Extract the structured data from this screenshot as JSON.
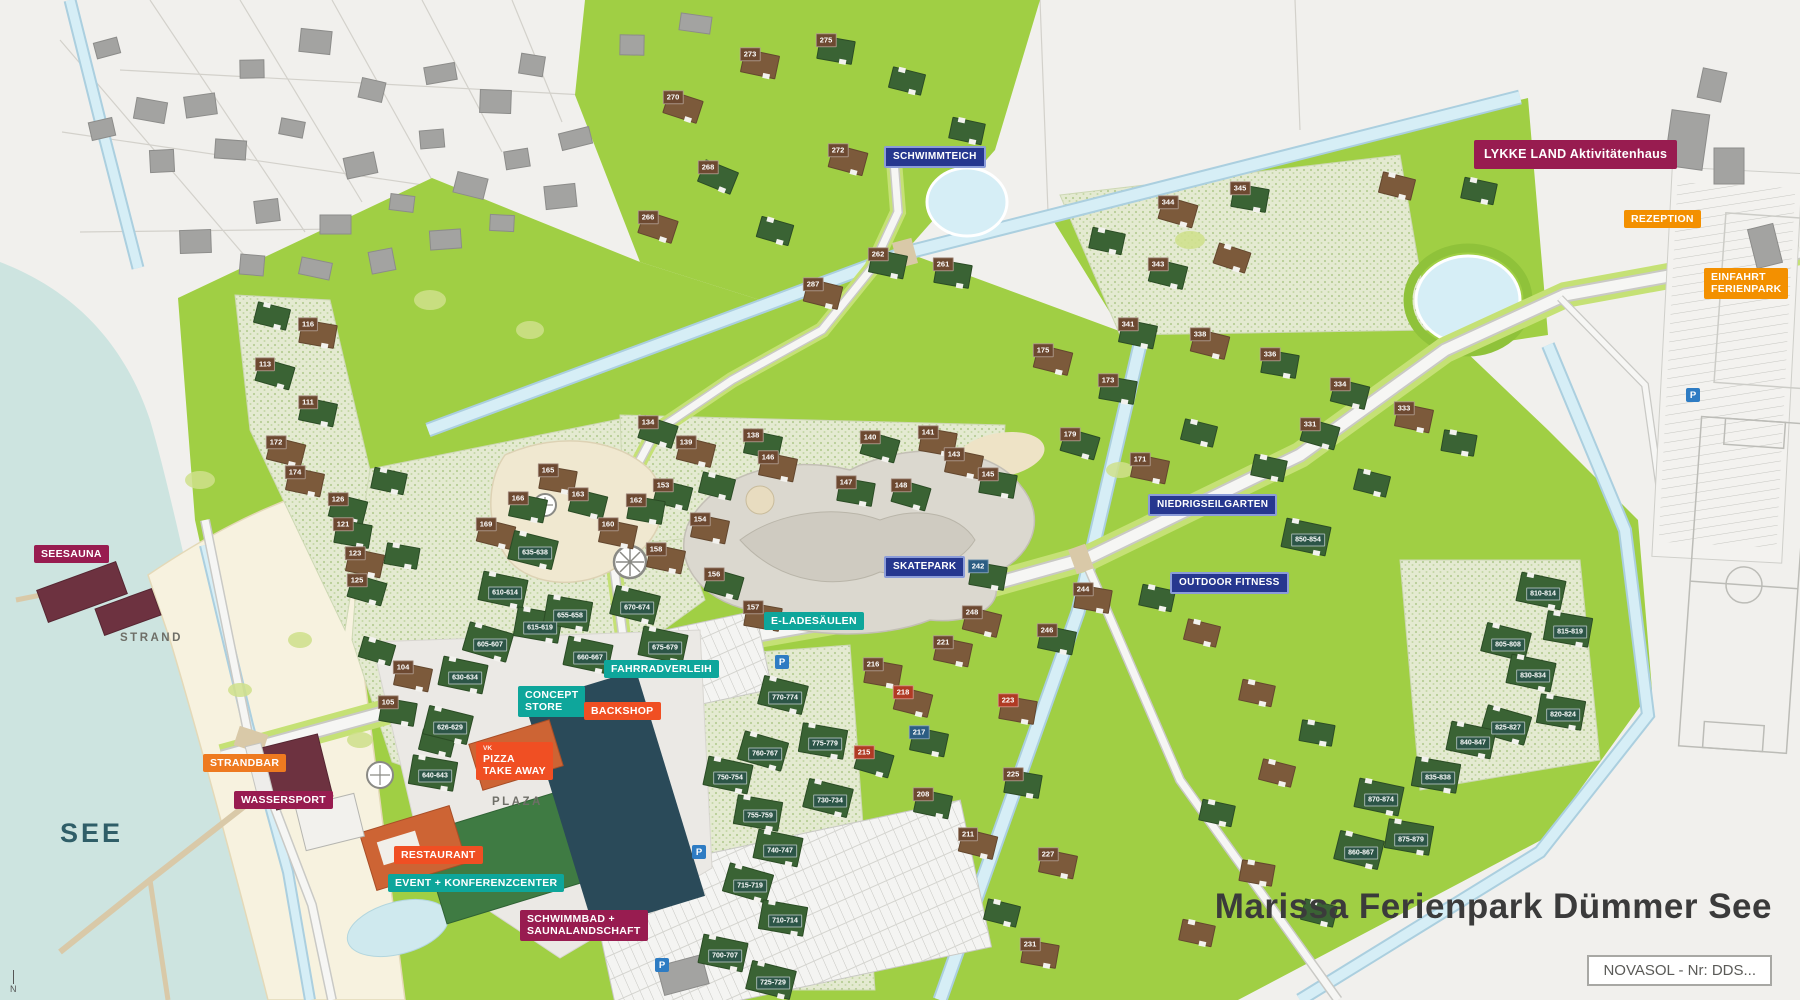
{
  "title": "Marissa Ferienpark Dümmer See",
  "info_box": "NOVASOL - Nr: DDS...",
  "north": "N",
  "areas": {
    "see": "SEE",
    "strand": "STRAND",
    "plaza": "PLAZA"
  },
  "colors": {
    "badge_berry": "#981c50",
    "badge_orange": "#f39000",
    "badge_orangered": "#f04f23",
    "badge_teal": "#0ea69b",
    "badge_blue": "#26378f",
    "badge_blue_border": "#8b9cd9",
    "house_range_badge": "#2c5547",
    "house_number_badge": "#6d4931",
    "park_green": "#a0cf44",
    "lake": "#cde4e0",
    "beach": "#f7f2df",
    "pool_building": "#2a4a59",
    "roof_green": "#3a6334",
    "roof_brown": "#7c5a3b",
    "parking_p": "#2e7cc3",
    "title_text": "#3b3b3b"
  },
  "poi_labels": [
    {
      "t": "SCHWIMMTEICH",
      "s": "blue",
      "x": 884,
      "y": 146
    },
    {
      "t": "LYKKE LAND Aktivitätenhaus",
      "s": "berry",
      "x": 1474,
      "y": 140,
      "big": 1
    },
    {
      "t": "REZEPTION",
      "s": "orange",
      "x": 1624,
      "y": 210
    },
    {
      "t": "EINFAHRT",
      "t2": "FERIENPARK",
      "s": "orange",
      "x": 1704,
      "y": 268
    },
    {
      "t": "NIEDRIGSEILGARTEN",
      "s": "blue",
      "x": 1148,
      "y": 494
    },
    {
      "t": "OUTDOOR FITNESS",
      "s": "blue",
      "x": 1170,
      "y": 572
    },
    {
      "t": "SKATEPARK",
      "s": "blue",
      "x": 884,
      "y": 556
    },
    {
      "t": "E-LADESÄULEN",
      "s": "teal",
      "x": 764,
      "y": 612
    },
    {
      "t": "FAHRRADVERLEIH",
      "s": "teal",
      "x": 604,
      "y": 660
    },
    {
      "t": "CONCEPT",
      "t2": "STORE",
      "s": "teal",
      "x": 518,
      "y": 686
    },
    {
      "t": "BACKSHOP",
      "s": "orangered",
      "x": 584,
      "y": 702
    },
    {
      "t": "PIZZA",
      "t2": "TAKE AWAY",
      "s": "orangered",
      "x": 476,
      "y": 742,
      "pre": "VK"
    },
    {
      "t": "RESTAURANT",
      "s": "orangered",
      "x": 394,
      "y": 846
    },
    {
      "t": "EVENT + KONFERENZCENTER",
      "s": "teal",
      "x": 388,
      "y": 874
    },
    {
      "t": "SCHWIMMBAD +",
      "t2": "SAUNALANDSCHAFT",
      "s": "berry",
      "x": 520,
      "y": 910
    },
    {
      "t": "SEESAUNA",
      "s": "berry",
      "x": 34,
      "y": 545
    },
    {
      "t": "STRANDBAR",
      "s": "orange2",
      "x": 203,
      "y": 754
    },
    {
      "t": "WASSERSPORT",
      "s": "berry",
      "x": 234,
      "y": 791
    }
  ],
  "parking_icons": [
    {
      "x": 775,
      "y": 655
    },
    {
      "x": 692,
      "y": 845
    },
    {
      "x": 655,
      "y": 958
    },
    {
      "x": 1686,
      "y": 388
    }
  ],
  "parking_icon_label": "P",
  "houses": [
    [
      665,
      95,
      18,
      "b",
      "270",
      "b"
    ],
    [
      742,
      52,
      12,
      "b",
      "273",
      "b"
    ],
    [
      818,
      38,
      10,
      "g",
      "275",
      "b"
    ],
    [
      890,
      70,
      14,
      "g",
      "",
      ""
    ],
    [
      830,
      148,
      15,
      "b",
      "272",
      "b"
    ],
    [
      700,
      165,
      22,
      "g",
      "268",
      "b"
    ],
    [
      640,
      215,
      18,
      "b",
      "266",
      "b"
    ],
    [
      758,
      220,
      16,
      "g",
      "",
      ""
    ],
    [
      870,
      252,
      12,
      "g",
      "262",
      "b"
    ],
    [
      805,
      282,
      14,
      "b",
      "287",
      "b"
    ],
    [
      935,
      262,
      10,
      "g",
      "261",
      "b"
    ],
    [
      950,
      120,
      12,
      "g",
      "",
      ""
    ],
    [
      1090,
      230,
      12,
      "g",
      "",
      ""
    ],
    [
      1160,
      200,
      16,
      "b",
      "344",
      "b"
    ],
    [
      1232,
      186,
      10,
      "g",
      "345",
      "b"
    ],
    [
      1150,
      262,
      14,
      "g",
      "343",
      "b"
    ],
    [
      1215,
      247,
      18,
      "b",
      "",
      ""
    ],
    [
      1120,
      322,
      12,
      "g",
      "341",
      "b"
    ],
    [
      1192,
      332,
      14,
      "b",
      "338",
      "b"
    ],
    [
      1262,
      352,
      10,
      "g",
      "336",
      "b"
    ],
    [
      1332,
      382,
      14,
      "g",
      "334",
      "b"
    ],
    [
      1396,
      406,
      12,
      "b",
      "333",
      "b"
    ],
    [
      1302,
      422,
      16,
      "g",
      "331",
      "b"
    ],
    [
      1442,
      432,
      10,
      "g",
      "",
      ""
    ],
    [
      1462,
      180,
      12,
      "g",
      "",
      ""
    ],
    [
      1380,
      175,
      14,
      "b",
      "",
      ""
    ],
    [
      1035,
      348,
      14,
      "b",
      "175",
      "b"
    ],
    [
      1100,
      378,
      10,
      "g",
      "173",
      "b"
    ],
    [
      1062,
      432,
      16,
      "g",
      "179",
      "b"
    ],
    [
      1132,
      457,
      12,
      "b",
      "171",
      "b"
    ],
    [
      1182,
      422,
      14,
      "g",
      "",
      ""
    ],
    [
      1252,
      457,
      12,
      "g",
      "",
      ""
    ],
    [
      640,
      420,
      18,
      "g",
      "134",
      "b"
    ],
    [
      678,
      440,
      14,
      "b",
      "139",
      "b"
    ],
    [
      745,
      433,
      12,
      "g",
      "138",
      "b"
    ],
    [
      862,
      435,
      16,
      "g",
      "140",
      "b"
    ],
    [
      920,
      430,
      10,
      "b",
      "141",
      "b"
    ],
    [
      700,
      475,
      14,
      "g",
      "",
      ""
    ],
    [
      760,
      455,
      12,
      "b",
      "146",
      "b"
    ],
    [
      838,
      480,
      10,
      "g",
      "147",
      "b"
    ],
    [
      893,
      483,
      16,
      "g",
      "148",
      "b"
    ],
    [
      946,
      452,
      12,
      "b",
      "143",
      "b"
    ],
    [
      980,
      472,
      10,
      "g",
      "145",
      "b"
    ],
    [
      655,
      483,
      14,
      "g",
      "153",
      "b"
    ],
    [
      692,
      517,
      12,
      "b",
      "154",
      "b"
    ],
    [
      706,
      572,
      16,
      "g",
      "156",
      "b"
    ],
    [
      745,
      605,
      10,
      "b",
      "157",
      "b"
    ],
    [
      648,
      547,
      12,
      "b",
      "158",
      "b"
    ],
    [
      628,
      498,
      10,
      "g",
      "162",
      "b"
    ],
    [
      600,
      522,
      12,
      "b",
      "160",
      "b"
    ],
    [
      570,
      492,
      14,
      "g",
      "163",
      "b"
    ],
    [
      540,
      468,
      10,
      "b",
      "165",
      "b"
    ],
    [
      510,
      496,
      12,
      "g",
      "166",
      "b"
    ],
    [
      478,
      522,
      14,
      "b",
      "169",
      "b"
    ],
    [
      255,
      305,
      14,
      "g",
      "",
      ""
    ],
    [
      300,
      322,
      10,
      "b",
      "116",
      "b"
    ],
    [
      257,
      362,
      16,
      "g",
      "113",
      "b"
    ],
    [
      300,
      400,
      12,
      "g",
      "111",
      "b"
    ],
    [
      268,
      440,
      14,
      "b",
      "172",
      "b"
    ],
    [
      287,
      470,
      12,
      "b",
      "174",
      "b"
    ],
    [
      330,
      497,
      14,
      "g",
      "126",
      "b"
    ],
    [
      335,
      522,
      10,
      "g",
      "121",
      "b"
    ],
    [
      347,
      551,
      12,
      "b",
      "123",
      "b"
    ],
    [
      349,
      578,
      16,
      "g",
      "125",
      "b"
    ],
    [
      385,
      545,
      10,
      "g",
      "",
      ""
    ],
    [
      372,
      470,
      12,
      "g",
      "",
      ""
    ],
    [
      360,
      640,
      16,
      "g",
      "",
      ""
    ],
    [
      395,
      665,
      12,
      "b",
      "104",
      "b"
    ],
    [
      380,
      700,
      10,
      "g",
      "105",
      "b"
    ],
    [
      420,
      732,
      14,
      "g",
      "",
      ""
    ],
    [
      480,
      575,
      12,
      "g",
      "610-614",
      "r"
    ],
    [
      515,
      610,
      10,
      "g",
      "615-619",
      "r"
    ],
    [
      465,
      627,
      16,
      "g",
      "605-607",
      "r"
    ],
    [
      440,
      660,
      12,
      "g",
      "630-634",
      "r"
    ],
    [
      425,
      710,
      14,
      "g",
      "626-629",
      "r"
    ],
    [
      410,
      758,
      10,
      "g",
      "640-643",
      "r"
    ],
    [
      510,
      535,
      14,
      "g",
      "635-638",
      "r"
    ],
    [
      545,
      598,
      10,
      "g",
      "655-658",
      "r"
    ],
    [
      565,
      640,
      12,
      "g",
      "660-667",
      "r"
    ],
    [
      612,
      590,
      14,
      "g",
      "670-674",
      "r"
    ],
    [
      640,
      630,
      12,
      "g",
      "675-679",
      "r"
    ],
    [
      760,
      680,
      14,
      "g",
      "770-774",
      "r"
    ],
    [
      800,
      726,
      10,
      "g",
      "775-779",
      "r"
    ],
    [
      740,
      736,
      16,
      "g",
      "760-767",
      "r"
    ],
    [
      705,
      760,
      12,
      "g",
      "750-754",
      "r"
    ],
    [
      805,
      783,
      14,
      "g",
      "730-734",
      "r"
    ],
    [
      735,
      798,
      10,
      "g",
      "755-759",
      "r"
    ],
    [
      755,
      833,
      12,
      "g",
      "740-747",
      "r"
    ],
    [
      725,
      868,
      16,
      "g",
      "715-719",
      "r"
    ],
    [
      760,
      903,
      10,
      "g",
      "710-714",
      "r"
    ],
    [
      700,
      938,
      12,
      "g",
      "700-707",
      "r"
    ],
    [
      748,
      965,
      14,
      "g",
      "725-729",
      "r"
    ],
    [
      935,
      640,
      12,
      "b",
      "221",
      "b"
    ],
    [
      865,
      662,
      10,
      "b",
      "216",
      "b"
    ],
    [
      895,
      690,
      14,
      "b",
      "218",
      "rd"
    ],
    [
      911,
      730,
      12,
      "g",
      "217",
      "bl"
    ],
    [
      856,
      750,
      16,
      "g",
      "215",
      "rd"
    ],
    [
      1000,
      698,
      10,
      "b",
      "223",
      "rd"
    ],
    [
      915,
      792,
      12,
      "g",
      "208",
      "b"
    ],
    [
      960,
      832,
      14,
      "b",
      "211",
      "b"
    ],
    [
      1005,
      772,
      10,
      "g",
      "225",
      "b"
    ],
    [
      1040,
      852,
      12,
      "b",
      "227",
      "b"
    ],
    [
      985,
      902,
      14,
      "g",
      "",
      ""
    ],
    [
      1022,
      942,
      10,
      "b",
      "231",
      "b"
    ],
    [
      970,
      564,
      10,
      "g",
      "242",
      "bl"
    ],
    [
      964,
      610,
      14,
      "b",
      "248",
      "b"
    ],
    [
      1039,
      628,
      12,
      "g",
      "246",
      "b"
    ],
    [
      1075,
      587,
      10,
      "b",
      "244",
      "b"
    ],
    [
      1140,
      587,
      12,
      "g",
      "",
      ""
    ],
    [
      1185,
      622,
      14,
      "b",
      "",
      ""
    ],
    [
      1283,
      522,
      12,
      "g",
      "850-854",
      "r"
    ],
    [
      1355,
      472,
      14,
      "g",
      "",
      ""
    ],
    [
      1518,
      576,
      12,
      "g",
      "810-814",
      "r"
    ],
    [
      1545,
      614,
      10,
      "g",
      "815-819",
      "r"
    ],
    [
      1483,
      627,
      14,
      "g",
      "805-808",
      "r"
    ],
    [
      1508,
      658,
      12,
      "g",
      "830-834",
      "r"
    ],
    [
      1538,
      697,
      10,
      "g",
      "820-824",
      "r"
    ],
    [
      1483,
      710,
      16,
      "g",
      "825-827",
      "r"
    ],
    [
      1448,
      725,
      12,
      "g",
      "840-847",
      "r"
    ],
    [
      1413,
      760,
      10,
      "g",
      "835-838",
      "r"
    ],
    [
      1356,
      782,
      12,
      "g",
      "870-874",
      "r"
    ],
    [
      1336,
      835,
      14,
      "g",
      "860-867",
      "r"
    ],
    [
      1386,
      822,
      10,
      "g",
      "875-879",
      "r"
    ],
    [
      1240,
      682,
      12,
      "b",
      "",
      ""
    ],
    [
      1300,
      722,
      10,
      "g",
      "",
      ""
    ],
    [
      1260,
      762,
      14,
      "b",
      "",
      ""
    ],
    [
      1200,
      802,
      12,
      "g",
      "",
      ""
    ],
    [
      1240,
      862,
      10,
      "b",
      "",
      ""
    ],
    [
      1302,
      902,
      14,
      "g",
      "",
      ""
    ],
    [
      1180,
      922,
      12,
      "b",
      "",
      ""
    ]
  ]
}
